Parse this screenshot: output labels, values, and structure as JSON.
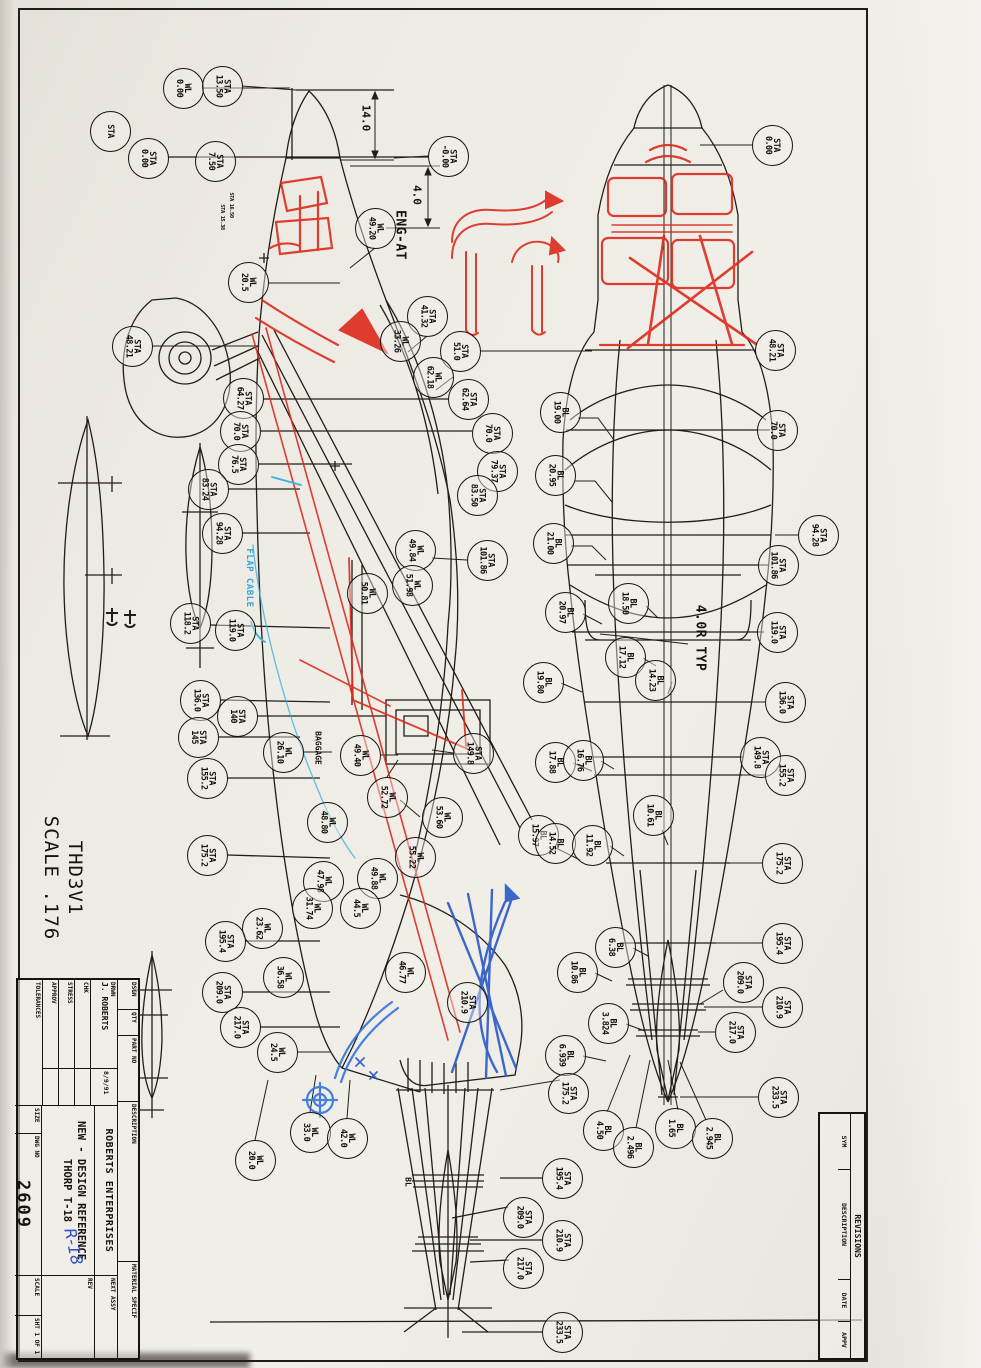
{
  "colors": {
    "ink": "#1e1b16",
    "red_pen": "#dc2a1c",
    "blue_pen": "#2d5cc8",
    "cyan_pen": "#35b2e2",
    "paper": "#edeae3"
  },
  "texts": {
    "sheet_title": "THD3V1",
    "sheet_scale": "SCALE .176",
    "eng_at": "ENG-AT",
    "dim_vert": "14.0",
    "dim_firewall": "4.0",
    "radius_note": "4.0R TYP",
    "flap_cable": "FLAP CABLE",
    "baggage": "BAGGAGE",
    "bl_note": "BL",
    "sta_small_a": "STA 16.50",
    "sta_small_b": "STA 15.38"
  },
  "title_block": {
    "company": "ROBERTS ENTERPRISES",
    "drawing_title": "NEW - DESIGN REFERENCE",
    "drawing_subtitle": "THORP T-18",
    "handwritten": "R-18",
    "dwg_no": "2609",
    "drwn_name": "J. ROBERTS",
    "drwn_date": "8/9/91",
    "labels": {
      "dsgn": "DSGN",
      "qty": "QTY",
      "part_no": "PART NO",
      "description": "DESCRIPTION",
      "material": "MATERIAL SPECIF",
      "drwn": "DRWN",
      "chk": "CHK",
      "stress": "STRESS",
      "approv": "APPROV",
      "tolerances": "TOLERANCES",
      "size": "SIZE",
      "dwg_no": "DWG NO",
      "next_assy": "NEXT ASSY",
      "scale": "SCALE",
      "sheet": "SHT 1 OF 1",
      "rev": "REV"
    }
  },
  "revision_block": {
    "title": "REVISIONS",
    "columns": [
      "SYM",
      "DESCRIPTION",
      "DATE",
      "APPV"
    ]
  },
  "balloons": [
    {
      "p": "WL",
      "v": "0.00",
      "x": 183,
      "y": 88
    },
    {
      "p": "STA",
      "v": "13.50",
      "x": 222,
      "y": 86
    },
    {
      "p": "STA",
      "v": "",
      "x": 110,
      "y": 131
    },
    {
      "p": "STA",
      "v": "0.00",
      "x": 148,
      "y": 158
    },
    {
      "p": "STA",
      "v": "7.50",
      "x": 215,
      "y": 161
    },
    {
      "p": "STA",
      "v": "-0.00",
      "x": 448,
      "y": 156
    },
    {
      "p": "WL",
      "v": "49.20",
      "x": 375,
      "y": 228
    },
    {
      "p": "WL",
      "v": "20.5",
      "x": 248,
      "y": 282
    },
    {
      "p": "STA",
      "v": "41.32",
      "x": 427,
      "y": 316
    },
    {
      "p": "STA",
      "v": "48.21",
      "x": 132,
      "y": 346
    },
    {
      "p": "WL",
      "v": "33.26",
      "x": 400,
      "y": 341
    },
    {
      "p": "STA",
      "v": "51.0",
      "x": 460,
      "y": 351
    },
    {
      "p": "WL",
      "v": "62.18",
      "x": 433,
      "y": 377
    },
    {
      "p": "STA",
      "v": "62.64",
      "x": 468,
      "y": 399
    },
    {
      "p": "STA",
      "v": "64.27",
      "x": 243,
      "y": 398
    },
    {
      "p": "STA",
      "v": "70.0",
      "x": 240,
      "y": 431
    },
    {
      "p": "STA",
      "v": "70.0",
      "x": 492,
      "y": 433
    },
    {
      "p": "STA",
      "v": "76.5",
      "x": 238,
      "y": 464
    },
    {
      "p": "STA",
      "v": "79.37",
      "x": 497,
      "y": 471
    },
    {
      "p": "STA",
      "v": "83.24",
      "x": 208,
      "y": 489
    },
    {
      "p": "STA",
      "v": "83.50",
      "x": 477,
      "y": 495
    },
    {
      "p": "STA",
      "v": "94.28",
      "x": 222,
      "y": 533
    },
    {
      "p": "WL",
      "v": "49.84",
      "x": 415,
      "y": 550
    },
    {
      "p": "STA",
      "v": "101.86",
      "x": 487,
      "y": 560
    },
    {
      "p": "WL",
      "v": "51.98",
      "x": 412,
      "y": 585
    },
    {
      "p": "WL",
      "v": "50.81",
      "x": 367,
      "y": 593
    },
    {
      "p": "STA",
      "v": "118.2",
      "x": 190,
      "y": 623
    },
    {
      "p": "STA",
      "v": "119.0",
      "x": 235,
      "y": 630
    },
    {
      "p": "STA",
      "v": "136.0",
      "x": 200,
      "y": 700
    },
    {
      "p": "STA",
      "v": "140",
      "x": 237,
      "y": 716
    },
    {
      "p": "STA",
      "v": "145",
      "x": 198,
      "y": 737
    },
    {
      "p": "WL",
      "v": "26.10",
      "x": 283,
      "y": 752
    },
    {
      "p": "WL",
      "v": "49.40",
      "x": 360,
      "y": 755
    },
    {
      "p": "STA",
      "v": "149.8",
      "x": 473,
      "y": 753
    },
    {
      "p": "STA",
      "v": "155.2",
      "x": 207,
      "y": 778
    },
    {
      "p": "WL",
      "v": "52.72",
      "x": 387,
      "y": 797
    },
    {
      "p": "WL",
      "v": "53.60",
      "x": 442,
      "y": 817
    },
    {
      "p": "WL",
      "v": "48.80",
      "x": 327,
      "y": 822
    },
    {
      "p": "STA",
      "v": "175.2",
      "x": 207,
      "y": 855
    },
    {
      "p": "WL",
      "v": "55.22",
      "x": 415,
      "y": 857
    },
    {
      "p": "WL",
      "v": "49.88",
      "x": 377,
      "y": 878
    },
    {
      "p": "WL",
      "v": "47.98",
      "x": 323,
      "y": 881
    },
    {
      "p": "WL",
      "v": "31.74",
      "x": 312,
      "y": 908
    },
    {
      "p": "WL",
      "v": "44.5",
      "x": 360,
      "y": 908
    },
    {
      "p": "WL",
      "v": "23.62",
      "x": 262,
      "y": 928
    },
    {
      "p": "STA",
      "v": "195.4",
      "x": 225,
      "y": 941
    },
    {
      "p": "WL",
      "v": "36.58",
      "x": 283,
      "y": 977
    },
    {
      "p": "STA",
      "v": "209.0",
      "x": 222,
      "y": 992
    },
    {
      "p": "WL",
      "v": "46.77",
      "x": 405,
      "y": 972
    },
    {
      "p": "STA",
      "v": "210.9",
      "x": 467,
      "y": 1002
    },
    {
      "p": "STA",
      "v": "217.0",
      "x": 240,
      "y": 1027
    },
    {
      "p": "WL",
      "v": "24.5",
      "x": 277,
      "y": 1052
    },
    {
      "p": "WL",
      "v": "20.0",
      "x": 255,
      "y": 1160
    },
    {
      "p": "WL",
      "v": "33.0",
      "x": 310,
      "y": 1132
    },
    {
      "p": "WL",
      "v": "42.0",
      "x": 347,
      "y": 1138
    },
    {
      "p": "STA",
      "v": "0.00",
      "x": 772,
      "y": 145
    },
    {
      "p": "STA",
      "v": "48.21",
      "x": 775,
      "y": 350
    },
    {
      "p": "BL",
      "v": "19.00",
      "x": 560,
      "y": 412
    },
    {
      "p": "STA",
      "v": "70.0",
      "x": 777,
      "y": 430
    },
    {
      "p": "BL",
      "v": "20.95",
      "x": 555,
      "y": 475
    },
    {
      "p": "BL",
      "v": "21.00",
      "x": 553,
      "y": 543
    },
    {
      "p": "STA",
      "v": "94.28",
      "x": 818,
      "y": 535
    },
    {
      "p": "STA",
      "v": "101.86",
      "x": 778,
      "y": 565
    },
    {
      "p": "BL",
      "v": "18.50",
      "x": 628,
      "y": 603
    },
    {
      "p": "BL",
      "v": "20.97",
      "x": 565,
      "y": 612
    },
    {
      "p": "STA",
      "v": "119.0",
      "x": 777,
      "y": 632
    },
    {
      "p": "BL",
      "v": "17.12",
      "x": 625,
      "y": 657
    },
    {
      "p": "BL",
      "v": "14.23",
      "x": 655,
      "y": 680
    },
    {
      "p": "BL",
      "v": "19.80",
      "x": 543,
      "y": 682
    },
    {
      "p": "STA",
      "v": "136.0",
      "x": 785,
      "y": 702
    },
    {
      "p": "BL",
      "v": "17.88",
      "x": 555,
      "y": 762
    },
    {
      "p": "BL",
      "v": "16.76",
      "x": 583,
      "y": 760
    },
    {
      "p": "STA",
      "v": "149.8",
      "x": 760,
      "y": 757
    },
    {
      "p": "STA",
      "v": "155.2",
      "x": 785,
      "y": 775
    },
    {
      "p": "BL",
      "v": "10.61",
      "x": 653,
      "y": 815
    },
    {
      "p": "BL",
      "v": "15.97",
      "x": 538,
      "y": 835
    },
    {
      "p": "BL",
      "v": "14.52",
      "x": 555,
      "y": 843
    },
    {
      "p": "BL",
      "v": "11.92",
      "x": 592,
      "y": 845
    },
    {
      "p": "STA",
      "v": "175.2",
      "x": 782,
      "y": 863
    },
    {
      "p": "BL",
      "v": "6.38",
      "x": 615,
      "y": 947
    },
    {
      "p": "BL",
      "v": "10.86",
      "x": 577,
      "y": 972
    },
    {
      "p": "STA",
      "v": "195.4",
      "x": 782,
      "y": 943
    },
    {
      "p": "STA",
      "v": "209.0",
      "x": 743,
      "y": 982
    },
    {
      "p": "STA",
      "v": "210.9",
      "x": 782,
      "y": 1007
    },
    {
      "p": "BL",
      "v": "3.824",
      "x": 608,
      "y": 1023
    },
    {
      "p": "STA",
      "v": "217.0",
      "x": 735,
      "y": 1032
    },
    {
      "p": "BL",
      "v": "6.939",
      "x": 565,
      "y": 1055
    },
    {
      "p": "STA",
      "v": "175.2",
      "x": 568,
      "y": 1093
    },
    {
      "p": "STA",
      "v": "233.5",
      "x": 778,
      "y": 1097
    },
    {
      "p": "BL",
      "v": "4.50",
      "x": 603,
      "y": 1130
    },
    {
      "p": "BL",
      "v": "2.496",
      "x": 633,
      "y": 1147
    },
    {
      "p": "BL",
      "v": "1.65",
      "x": 675,
      "y": 1128
    },
    {
      "p": "BL",
      "v": "2.945",
      "x": 712,
      "y": 1138
    },
    {
      "p": "STA",
      "v": "195.4",
      "x": 562,
      "y": 1178
    },
    {
      "p": "STA",
      "v": "209.0",
      "x": 523,
      "y": 1217
    },
    {
      "p": "STA",
      "v": "210.9",
      "x": 562,
      "y": 1240
    },
    {
      "p": "STA",
      "v": "217.0",
      "x": 523,
      "y": 1268
    },
    {
      "p": "STA",
      "v": "233.5",
      "x": 562,
      "y": 1332
    }
  ]
}
